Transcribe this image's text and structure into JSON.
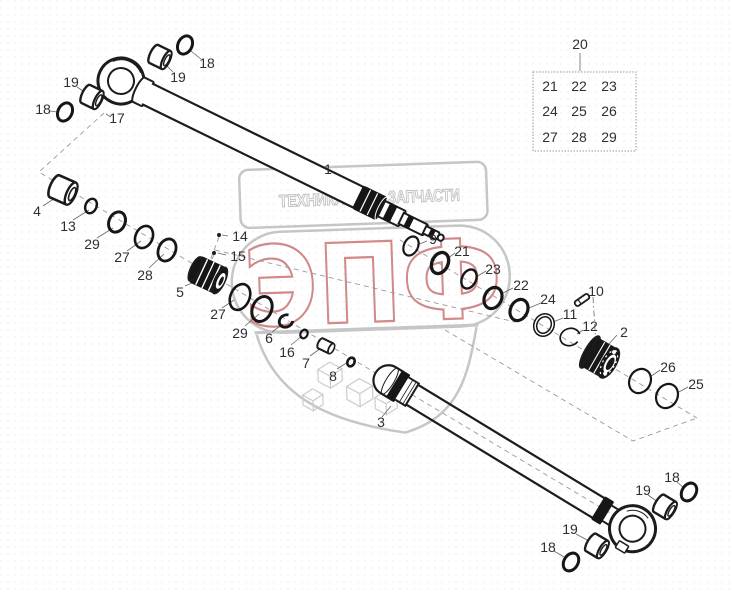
{
  "watermark": {
    "banner_left": "ТЕХНИКА",
    "banner_right": "ЗАПЧАСТИ",
    "big_text": "ЭПФ",
    "accent_color": "#d28989",
    "gray": "#c6c6c6"
  },
  "table": {
    "title": "20",
    "rows": [
      [
        "21",
        "22",
        "23"
      ],
      [
        "24",
        "25",
        "26"
      ],
      [
        "27",
        "28",
        "29"
      ]
    ]
  },
  "colors": {
    "line": "#1c1c1c",
    "watermark_gray": "#c6c6c6",
    "accent_red": "#d28989",
    "background": "#ffffff"
  },
  "callouts": [
    {
      "text": "1",
      "x": 328,
      "y": 174
    },
    {
      "text": "9",
      "x": 433,
      "y": 244
    },
    {
      "text": "21",
      "x": 462,
      "y": 256
    },
    {
      "text": "23",
      "x": 493,
      "y": 274
    },
    {
      "text": "22",
      "x": 521,
      "y": 290
    },
    {
      "text": "24",
      "x": 548,
      "y": 304
    },
    {
      "text": "10",
      "x": 596,
      "y": 296
    },
    {
      "text": "11",
      "x": 570,
      "y": 319
    },
    {
      "text": "12",
      "x": 590,
      "y": 331
    },
    {
      "text": "2",
      "x": 624,
      "y": 337
    },
    {
      "text": "26",
      "x": 668,
      "y": 372
    },
    {
      "text": "25",
      "x": 696,
      "y": 389
    },
    {
      "text": "17",
      "x": 117,
      "y": 123
    },
    {
      "text": "18",
      "x": 207,
      "y": 68
    },
    {
      "text": "19",
      "x": 178,
      "y": 82
    },
    {
      "text": "19",
      "x": 71,
      "y": 87
    },
    {
      "text": "18",
      "x": 43,
      "y": 114
    },
    {
      "text": "4",
      "x": 37,
      "y": 216
    },
    {
      "text": "13",
      "x": 68,
      "y": 231
    },
    {
      "text": "29",
      "x": 92,
      "y": 249
    },
    {
      "text": "27",
      "x": 122,
      "y": 262
    },
    {
      "text": "28",
      "x": 145,
      "y": 280
    },
    {
      "text": "5",
      "x": 180,
      "y": 297
    },
    {
      "text": "14",
      "x": 240,
      "y": 241
    },
    {
      "text": "15",
      "x": 238,
      "y": 261
    },
    {
      "text": "27",
      "x": 218,
      "y": 319
    },
    {
      "text": "29",
      "x": 240,
      "y": 338
    },
    {
      "text": "6",
      "x": 269,
      "y": 343
    },
    {
      "text": "16",
      "x": 287,
      "y": 357
    },
    {
      "text": "7",
      "x": 306,
      "y": 368
    },
    {
      "text": "8",
      "x": 333,
      "y": 381
    },
    {
      "text": "3",
      "x": 381,
      "y": 427
    },
    {
      "text": "19",
      "x": 643,
      "y": 495
    },
    {
      "text": "18",
      "x": 672,
      "y": 482
    },
    {
      "text": "19",
      "x": 570,
      "y": 534
    },
    {
      "text": "18",
      "x": 548,
      "y": 552
    }
  ]
}
